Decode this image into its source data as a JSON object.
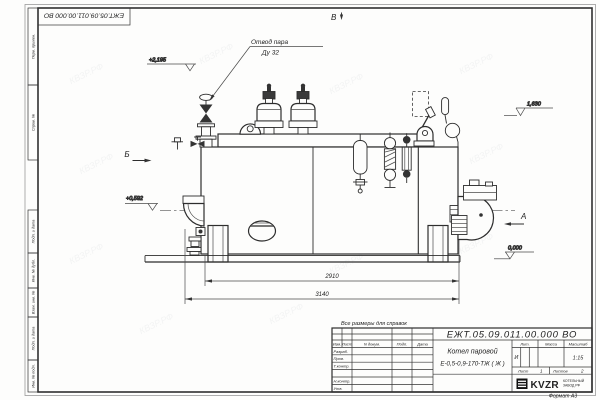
{
  "frame": {
    "stamp_doc_number": "ЕЖТ.05.09.011.00.000  ВО",
    "side_labels": [
      "Перв. примен.",
      "Справ. №",
      "Подп. и дата",
      "Инв. № дубл.",
      "Взам. инв. №",
      "Подп. и дата",
      "Инв. № подл."
    ],
    "format_label": "Формат А3",
    "watermark": "КВЗР.РФ"
  },
  "drawing": {
    "callout_line1": "Отвод пара",
    "callout_line2": "Ду 32",
    "level_top": "+2,195",
    "level_right": "1,630",
    "level_left": "+0,592",
    "level_zero": "0,000",
    "view_top": "В",
    "view_left": "Б",
    "view_right": "А",
    "dim_inner": "2910",
    "dim_outer": "3140"
  },
  "title_block": {
    "note": "Все размеры для справок",
    "doc_number": "ЕЖТ.05.09.011.00.000  ВО",
    "header_cols": [
      "Изм.",
      "Лист",
      "N докум.",
      "Подп.",
      "Дата"
    ],
    "row_labels": [
      "Разраб.",
      "Пров.",
      "Т.контр.",
      "Н.контр.",
      "Утв."
    ],
    "title_line1": "Котел паровой",
    "title_line2": "Е-0,5-0,9-170-ТЖ ( Ж )",
    "lit_header": "Лит.",
    "mass_header": "Масса",
    "scale_header": "Масштаб",
    "lit_value": "И",
    "scale_value": "1:15",
    "sheet_label": "Лист",
    "sheet_value": "1",
    "sheets_label": "Листов",
    "sheets_value": "2",
    "logo_text": "KVZR",
    "logo_caption1": "КОТЕЛЬНЫЙ",
    "logo_caption2": "ЗАВОД РФ"
  }
}
